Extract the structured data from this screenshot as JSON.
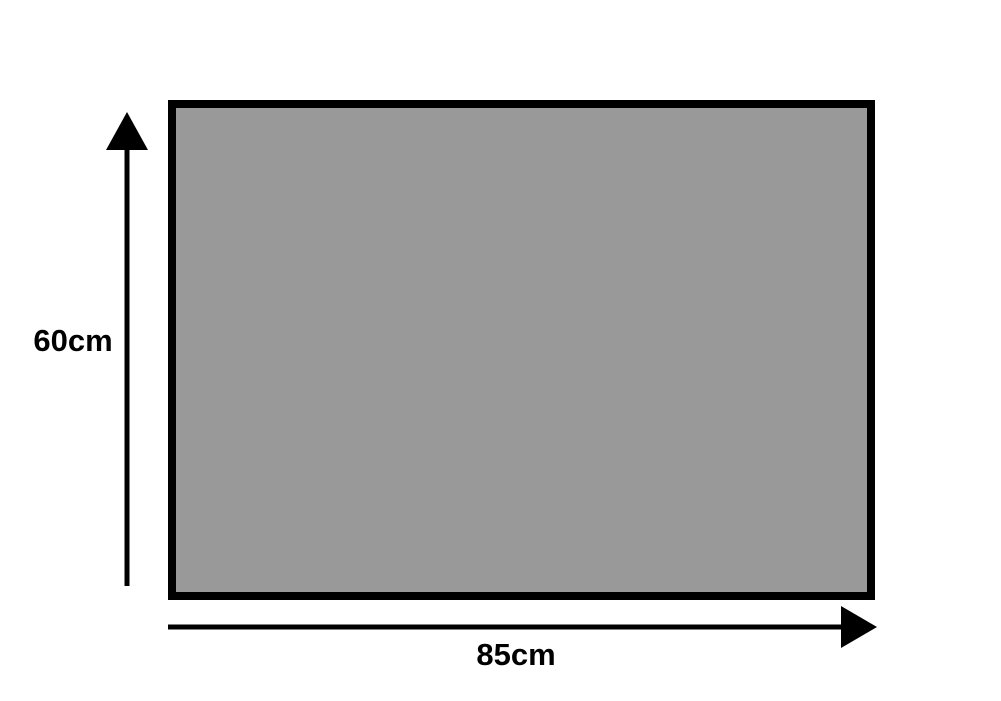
{
  "diagram": {
    "title": "rectangle-dimension-diagram",
    "shape": {
      "type": "rectangle",
      "width_label": "85cm",
      "height_label": "60cm",
      "width_value_cm": 85,
      "height_value_cm": 60
    },
    "colors": {
      "shape_fill": "#999999",
      "shape_border": "#000000",
      "arrow": "#000000",
      "label_text": "#000000",
      "background": "#ffffff"
    }
  }
}
